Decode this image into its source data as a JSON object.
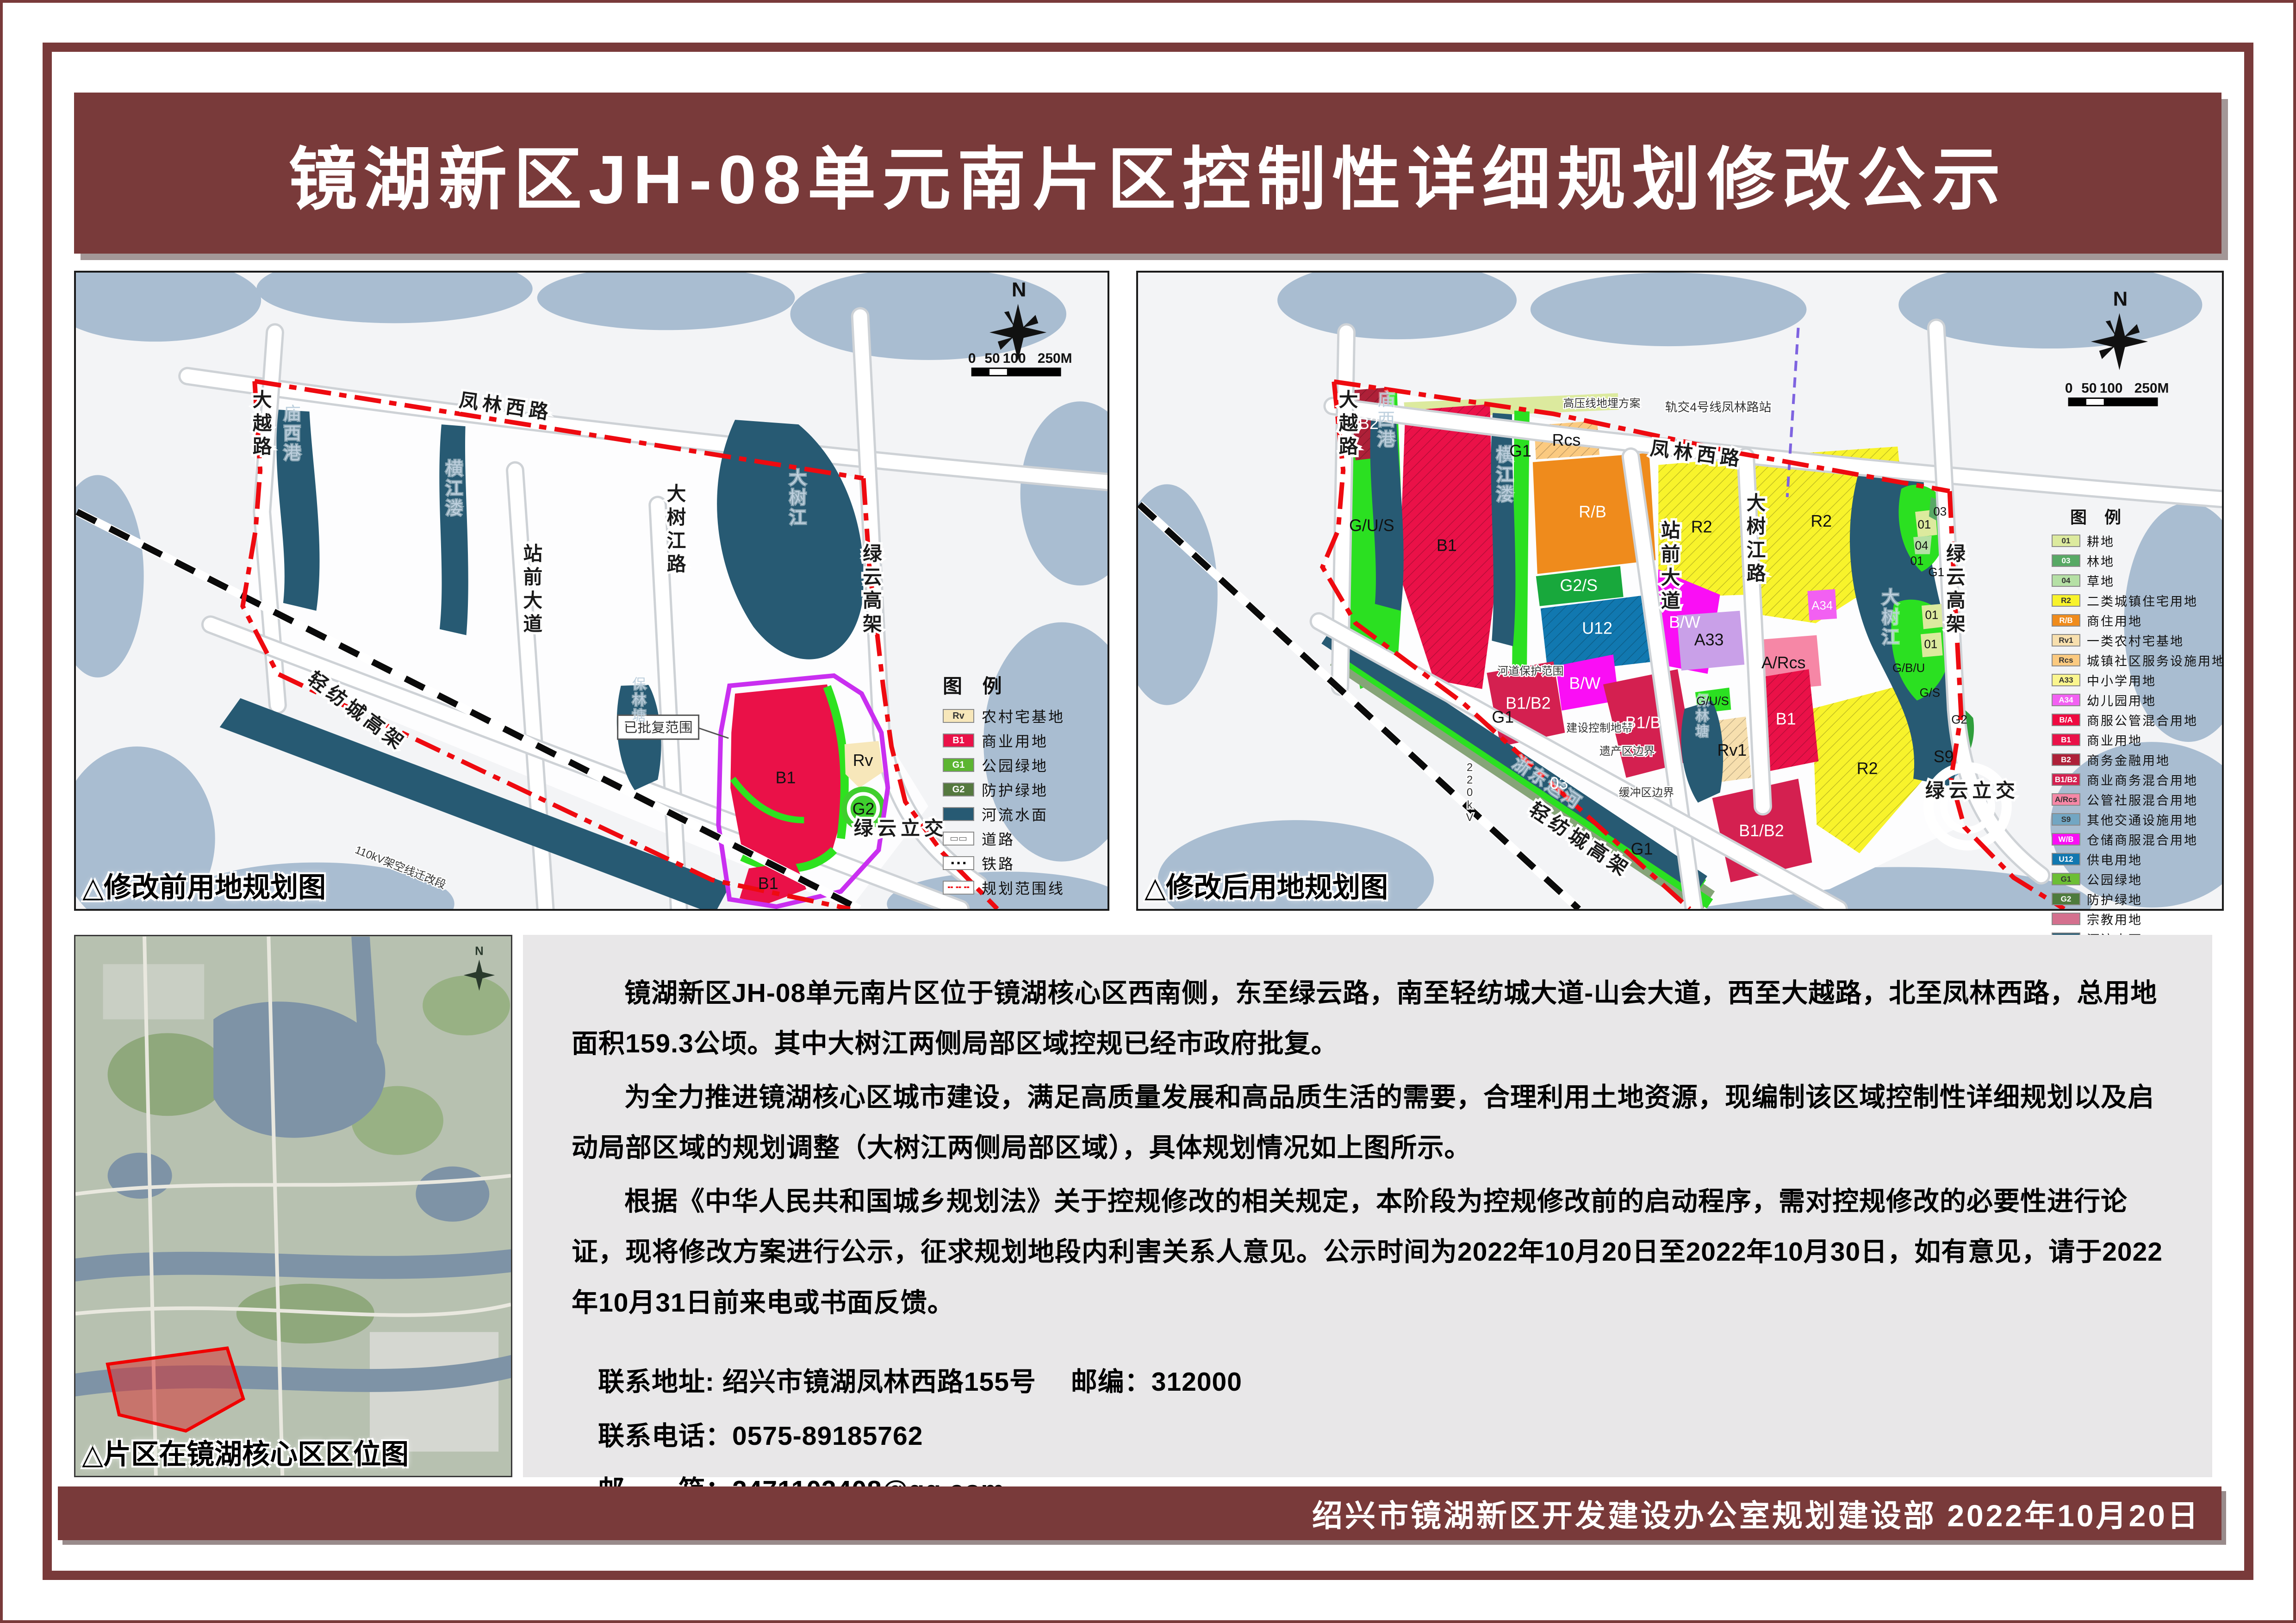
{
  "page": {
    "title": "镜湖新区JH-08单元南片区控制性详细规划修改公示",
    "footer": "绍兴市镜湖新区开发建设办公室规划建设部  2022年10月20日",
    "colors": {
      "maroon": "#793a3a",
      "panel_gray": "#e8e7e8",
      "water_bg": "#a9bdd1",
      "river": "#275a73",
      "boundary_red": "#ee0a10",
      "approved_purple": "#c92ff0"
    }
  },
  "notice": {
    "paragraphs": [
      "镜湖新区JH-08单元南片区位于镜湖核心区西南侧，东至绿云路，南至轻纺城大道-山会大道，西至大越路，北至凤林西路，总用地面积159.3公顷。其中大树江两侧局部区域控规已经市政府批复。",
      "为全力推进镜湖核心区城市建设，满足高质量发展和高品质生活的需要，合理利用土地资源，现编制该区域控制性详细规划以及启动局部区域的规划调整（大树江两侧局部区域），具体规划情况如上图所示。",
      "根据《中华人民共和国城乡规划法》关于控规修改的相关规定，本阶段为控规修改前的启动程序，需对控规修改的必要性进行论证，现将修改方案进行公示，征求规划地段内利害关系人意见。公示时间为2022年10月20日至2022年10月30日，如有意见，请于2022年10月31日前来电或书面反馈。"
    ],
    "contact": [
      "联系地址: 绍兴市镜湖凤林西路155号　 邮编：312000",
      "联系电话：0575-89185762",
      "邮　　箱：2471103408@qq.com"
    ]
  },
  "location": {
    "caption": "△片区在镜湖核心区区位图",
    "north": "N"
  },
  "maps": {
    "before": {
      "caption": "△修改前用地规划图",
      "legend_title": "图 例",
      "north": "N",
      "scale": [
        "0",
        "50",
        "100",
        "250M"
      ],
      "legend": [
        {
          "code": "Rv",
          "label": "农村宅基地",
          "color": "#f7e7ba",
          "tc": "#333"
        },
        {
          "code": "B1",
          "label": "商业用地",
          "color": "#ea1148",
          "tc": "#fff"
        },
        {
          "code": "G1",
          "label": "公园绿地",
          "color": "#5cb531",
          "tc": "#fff"
        },
        {
          "code": "G2",
          "label": "防护绿地",
          "color": "#55793f",
          "tc": "#fff"
        },
        {
          "code": "",
          "label": "河流水面",
          "color": "#275a73",
          "tc": "#fff"
        },
        {
          "code": "",
          "label": "道路",
          "color": "#ffffff",
          "sym": "▭▭",
          "symc": "#666"
        },
        {
          "code": "",
          "label": "铁路",
          "color": "#ffffff",
          "sym": "▪ ▪ ▪",
          "symc": "#000"
        },
        {
          "code": "",
          "label": "规划范围线",
          "color": "#ffffff",
          "sym": "╍ ╍ ╍",
          "symc": "#ee0a10"
        }
      ],
      "roads": [
        "凤林西路",
        "大越路",
        "站前大道",
        "大树江路",
        "绿云高架",
        "轻纺城高架",
        "绿云立交"
      ],
      "waters": [
        "庙西港",
        "横江溇",
        "大树江",
        "保林塘"
      ],
      "notes": [
        "已批复范围",
        "110kV架空线迁改段"
      ],
      "zones": [
        "B1",
        "B1",
        "Rv",
        "G2"
      ]
    },
    "after": {
      "caption": "△修改后用地规划图",
      "legend_title": "图 例",
      "north": "N",
      "scale": [
        "0",
        "50",
        "100",
        "250M"
      ],
      "legend": [
        {
          "code": "01",
          "label": "耕地",
          "color": "#dcea9e",
          "tc": "#333"
        },
        {
          "code": "03",
          "label": "林地",
          "color": "#57a965",
          "tc": "#fff"
        },
        {
          "code": "04",
          "label": "草地",
          "color": "#b5e0a5",
          "tc": "#333"
        },
        {
          "code": "R2",
          "label": "二类城镇住宅用地",
          "color": "#f8f32b",
          "tc": "#333"
        },
        {
          "code": "R/B",
          "label": "商住用地",
          "color": "#ef8b1c",
          "tc": "#fff"
        },
        {
          "code": "Rv1",
          "label": "一类农村宅基地",
          "color": "#f7dfae",
          "tc": "#333"
        },
        {
          "code": "Rcs",
          "label": "城镇社区服务设施用地",
          "color": "#fbca80",
          "tc": "#333"
        },
        {
          "code": "A33",
          "label": "中小学用地",
          "color": "#faf58e",
          "tc": "#333"
        },
        {
          "code": "A34",
          "label": "幼儿园用地",
          "color": "#f260f2",
          "tc": "#fff"
        },
        {
          "code": "B/A",
          "label": "商服公管混合用地",
          "color": "#ef0940",
          "tc": "#fff"
        },
        {
          "code": "B1",
          "label": "商业用地",
          "color": "#ea1148",
          "tc": "#fff"
        },
        {
          "code": "B2",
          "label": "商务金融用地",
          "color": "#ae2038",
          "tc": "#fff"
        },
        {
          "code": "B1/B2",
          "label": "商业商务混合用地",
          "color": "#d42050",
          "tc": "#fff"
        },
        {
          "code": "A/Rcs",
          "label": "公管社服混合用地",
          "color": "#f687a6",
          "tc": "#333"
        },
        {
          "code": "S9",
          "label": "其他交通设施用地",
          "color": "#72a6c3",
          "tc": "#333"
        },
        {
          "code": "W/B",
          "label": "仓储商服混合用地",
          "color": "#fa0ef5",
          "tc": "#fff"
        },
        {
          "code": "U12",
          "label": "供电用地",
          "color": "#1178b0",
          "tc": "#fff"
        },
        {
          "code": "G1",
          "label": "公园绿地",
          "color": "#6cbe35",
          "tc": "#333"
        },
        {
          "code": "G2",
          "label": "防护绿地",
          "color": "#4e7b3d",
          "tc": "#fff"
        },
        {
          "code": "",
          "label": "宗教用地",
          "color": "#d4708e",
          "tc": "#fff"
        },
        {
          "code": "",
          "label": "河流水面",
          "color": "#275a73",
          "tc": "#fff"
        },
        {
          "code": "",
          "label": "道路",
          "color": "#ffffff",
          "sym": "▭▭",
          "symc": "#666"
        },
        {
          "code": "",
          "label": "铁路",
          "color": "#ffffff",
          "sym": "▪ ▪ ▪",
          "symc": "#000"
        },
        {
          "code": "",
          "label": "规划范围线",
          "color": "#ffffff",
          "sym": "╍ ╍ ╍",
          "symc": "#ee0a10"
        }
      ],
      "roads": [
        "凤林西路",
        "大越路",
        "站前大道",
        "大树江路",
        "绿云高架",
        "轻纺城高架",
        "绿云立交",
        "轨交4号线凤林路站"
      ],
      "waters": [
        "庙西港",
        "横江溇",
        "大树江",
        "保林塘",
        "浙东运河"
      ],
      "notes": [
        "高压线地埋方案",
        "河道保护范围",
        "建设控制地带",
        "遗产区边界",
        "缓冲区边界",
        "220kV"
      ],
      "zones": [
        "B2",
        "G/U/S",
        "B1",
        "G1",
        "Rcs",
        "R/B",
        "G2/S",
        "U12",
        "B/W",
        "B/W",
        "B1/B2",
        "R2",
        "R2",
        "R2",
        "A34",
        "A33",
        "A/Rcs",
        "G/U/S",
        "Rv1",
        "B1",
        "B1/B2",
        "G1",
        "03",
        "G1",
        "B1/B2",
        "01",
        "01",
        "G/B/U",
        "G/S",
        "03",
        "01",
        "04",
        "01",
        "G1",
        "G2",
        "S9"
      ]
    }
  }
}
